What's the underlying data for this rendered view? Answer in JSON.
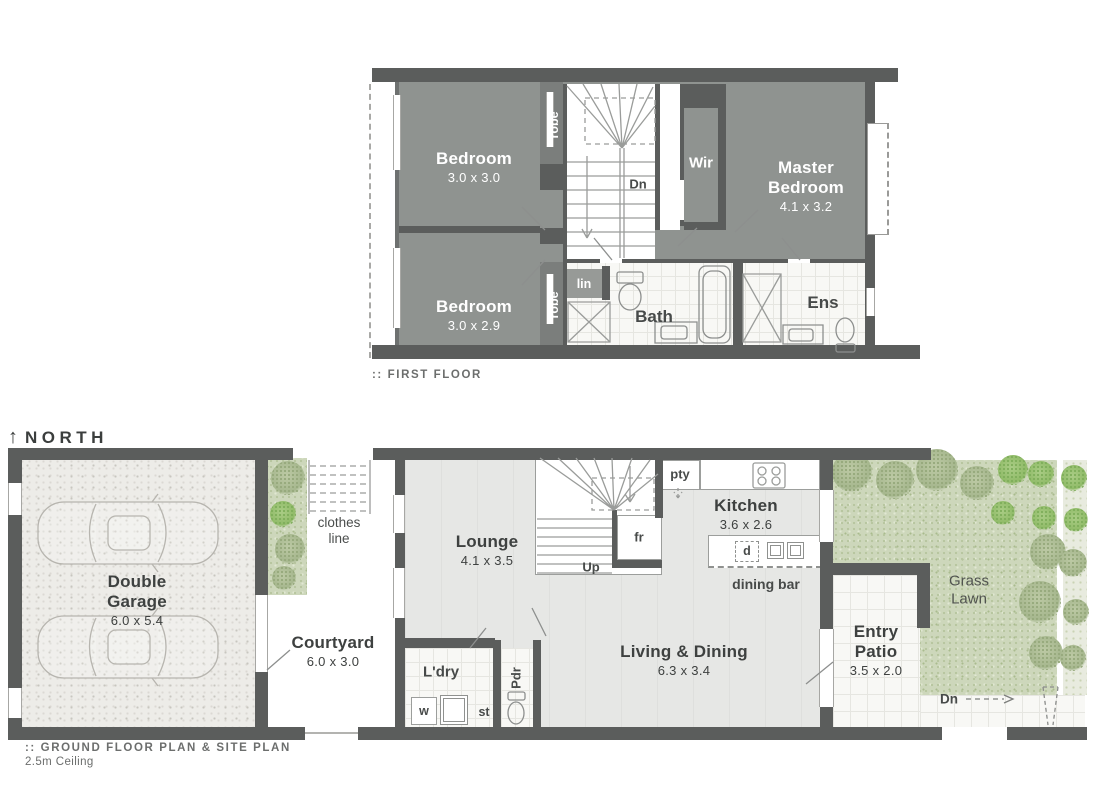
{
  "first_floor": {
    "caption": ":: FIRST FLOOR",
    "bedroom1": {
      "name": "Bedroom",
      "dims": "3.0 x 3.0"
    },
    "bedroom2": {
      "name": "Bedroom",
      "dims": "3.0 x 2.9"
    },
    "master": {
      "name": "Master Bedroom",
      "dims": "4.1 x 3.2"
    },
    "wir": "Wir",
    "dn": "Dn",
    "robe": "robe",
    "lin": "lin",
    "bath": "Bath",
    "ens": "Ens"
  },
  "ground_floor": {
    "caption": ":: GROUND FLOOR PLAN & SITE PLAN",
    "ceiling_note": "2.5m Ceiling",
    "north": "NORTH",
    "north_arrow": "↑",
    "garage": {
      "name": "Double Garage",
      "dims": "6.0 x 5.4"
    },
    "courtyard": {
      "name": "Courtyard",
      "dims": "6.0 x 3.0"
    },
    "clothes_line": "clothes line",
    "lounge": {
      "name": "Lounge",
      "dims": "4.1 x 3.5"
    },
    "up": "Up",
    "fridge": "fr",
    "pantry": "pty",
    "kitchen": {
      "name": "Kitchen",
      "dims": "3.6 x 2.6"
    },
    "dishwasher": "d",
    "dining_bar": "dining bar",
    "living": {
      "name": "Living & Dining",
      "dims": "6.3 x 3.4"
    },
    "laundry": "L'dry",
    "washer": "w",
    "tub": "st",
    "powder": "Pdr",
    "entry_patio": {
      "name": "Entry Patio",
      "dims": "3.5 x 2.0"
    },
    "grass_lawn": "Grass Lawn",
    "dn": "Dn"
  },
  "colors": {
    "wall": "#5b5d5c",
    "upper_room_fill": "#8f9390",
    "ground_floor_fill": "#e6e7e5",
    "grass": "#cdd7bb",
    "garage_fill": "#edece8",
    "label_dark": "#3e4140",
    "label_white": "#ffffff"
  }
}
